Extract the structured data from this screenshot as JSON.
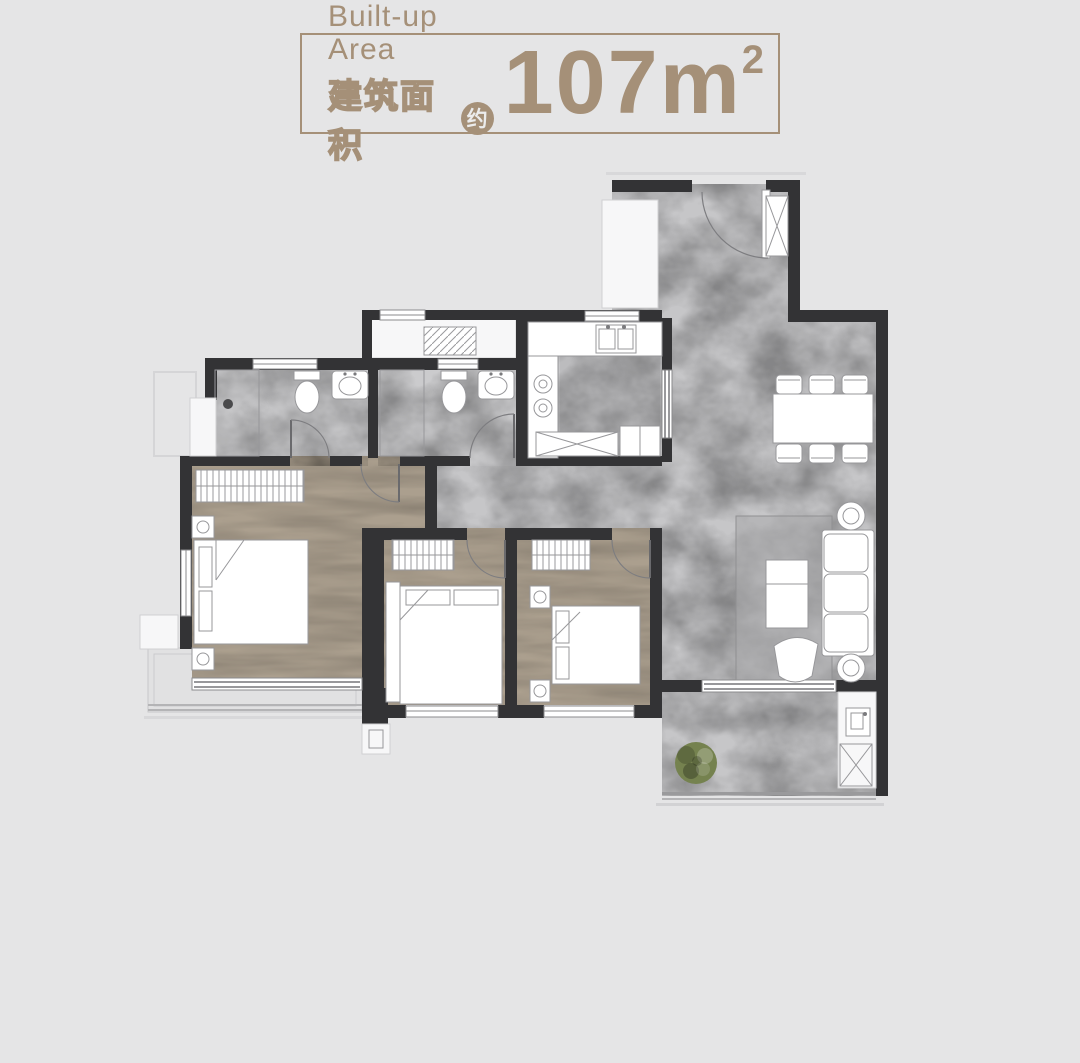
{
  "page": {
    "bg": "#e5e5e6"
  },
  "header": {
    "en_label": "Built-up Area",
    "zh_label": "建筑面积",
    "approx": "约",
    "value": "107m",
    "sup": "2",
    "accent": "#a59078"
  },
  "plan": {
    "colors": {
      "wall": "#333335",
      "marble": "#c6c6c8",
      "tile": "#cbcbcd",
      "wood": "#ab9f8e",
      "balcony": "#e1e1e2",
      "furniture": "#ffffff",
      "rug": "#a9a9ab",
      "plant": "#75824f"
    }
  }
}
